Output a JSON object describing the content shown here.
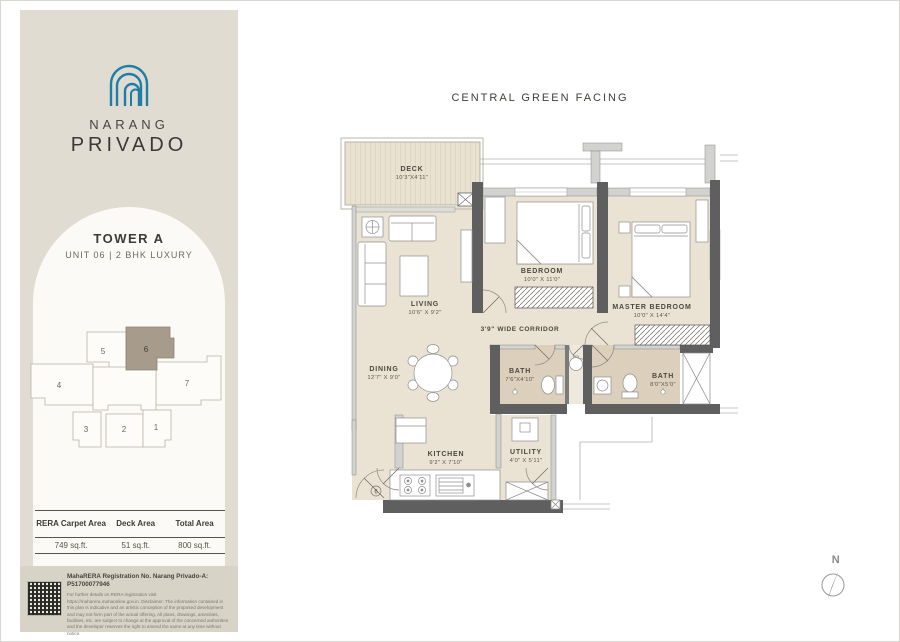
{
  "colors": {
    "sidebar_bg": "#e0dcd2",
    "panel_bg": "#fbfaf6",
    "logo_blue": "#1e7ea8",
    "floor": "#eae2d3",
    "bath_floor": "#dccfbc",
    "wall_dark": "#5f5f5f",
    "wall_light": "#d2d2d0",
    "highlight_unit": "#a79b8c",
    "legal_bg": "#d7d3c7"
  },
  "sidebar": {
    "brand": {
      "line1": "NARANG",
      "line2": "PRIVADO",
      "logo": "triple-arch-icon"
    },
    "tower": {
      "title": "TOWER A",
      "subtitle": "UNIT 06  |  2 BHK LUXURY"
    },
    "keyplan": {
      "units": [
        "1",
        "2",
        "3",
        "4",
        "5",
        "6",
        "7"
      ],
      "highlighted": "6"
    },
    "table": {
      "headers": [
        "RERA Carpet Area",
        "Deck Area",
        "Total Area"
      ],
      "values": [
        "749 sq.ft.",
        "51 sq.ft.",
        "800 sq.ft."
      ]
    },
    "legal": {
      "registration": "MahaRERA Registration No. Narang Privado-A: P51700077946",
      "disclaimer": "For further details on RERA registration visit https://maharera.mahaonline.gov.in. Disclaimer: The information contained in this plan is indicative and an artistic conception of the proposed development and may not form part of the actual offering. All plans, drawings, amenities, facilities, etc. are subject to change at the approval of the concerned authorities and the developer reserves the right to amend the same at any time without notice."
    }
  },
  "plan": {
    "facing_title": "CENTRAL GREEN FACING",
    "compass_label": "N",
    "entrance_marker": "6",
    "corridor_label": "3'9\" WIDE CORRIDOR",
    "rooms": {
      "deck": {
        "name": "DECK",
        "dims": "10'3\"X4'11\""
      },
      "living": {
        "name": "LIVING",
        "dims": "10'6\" X 9'2\""
      },
      "dining": {
        "name": "DINING",
        "dims": "12'7\" X 9'0\""
      },
      "bedroom": {
        "name": "BEDROOM",
        "dims": "10'0\" X 11'0\""
      },
      "master": {
        "name": "MASTER BEDROOM",
        "dims": "10'0\" X 14'4\""
      },
      "bath1": {
        "name": "BATH",
        "dims": "7'6\"X4'10\""
      },
      "bath2": {
        "name": "BATH",
        "dims": "8'0\"X5'0\""
      },
      "kitchen": {
        "name": "KITCHEN",
        "dims": "9'2\" X 7'10\""
      },
      "utility": {
        "name": "UTILITY",
        "dims": "4'0\" X 5'11\""
      }
    }
  }
}
